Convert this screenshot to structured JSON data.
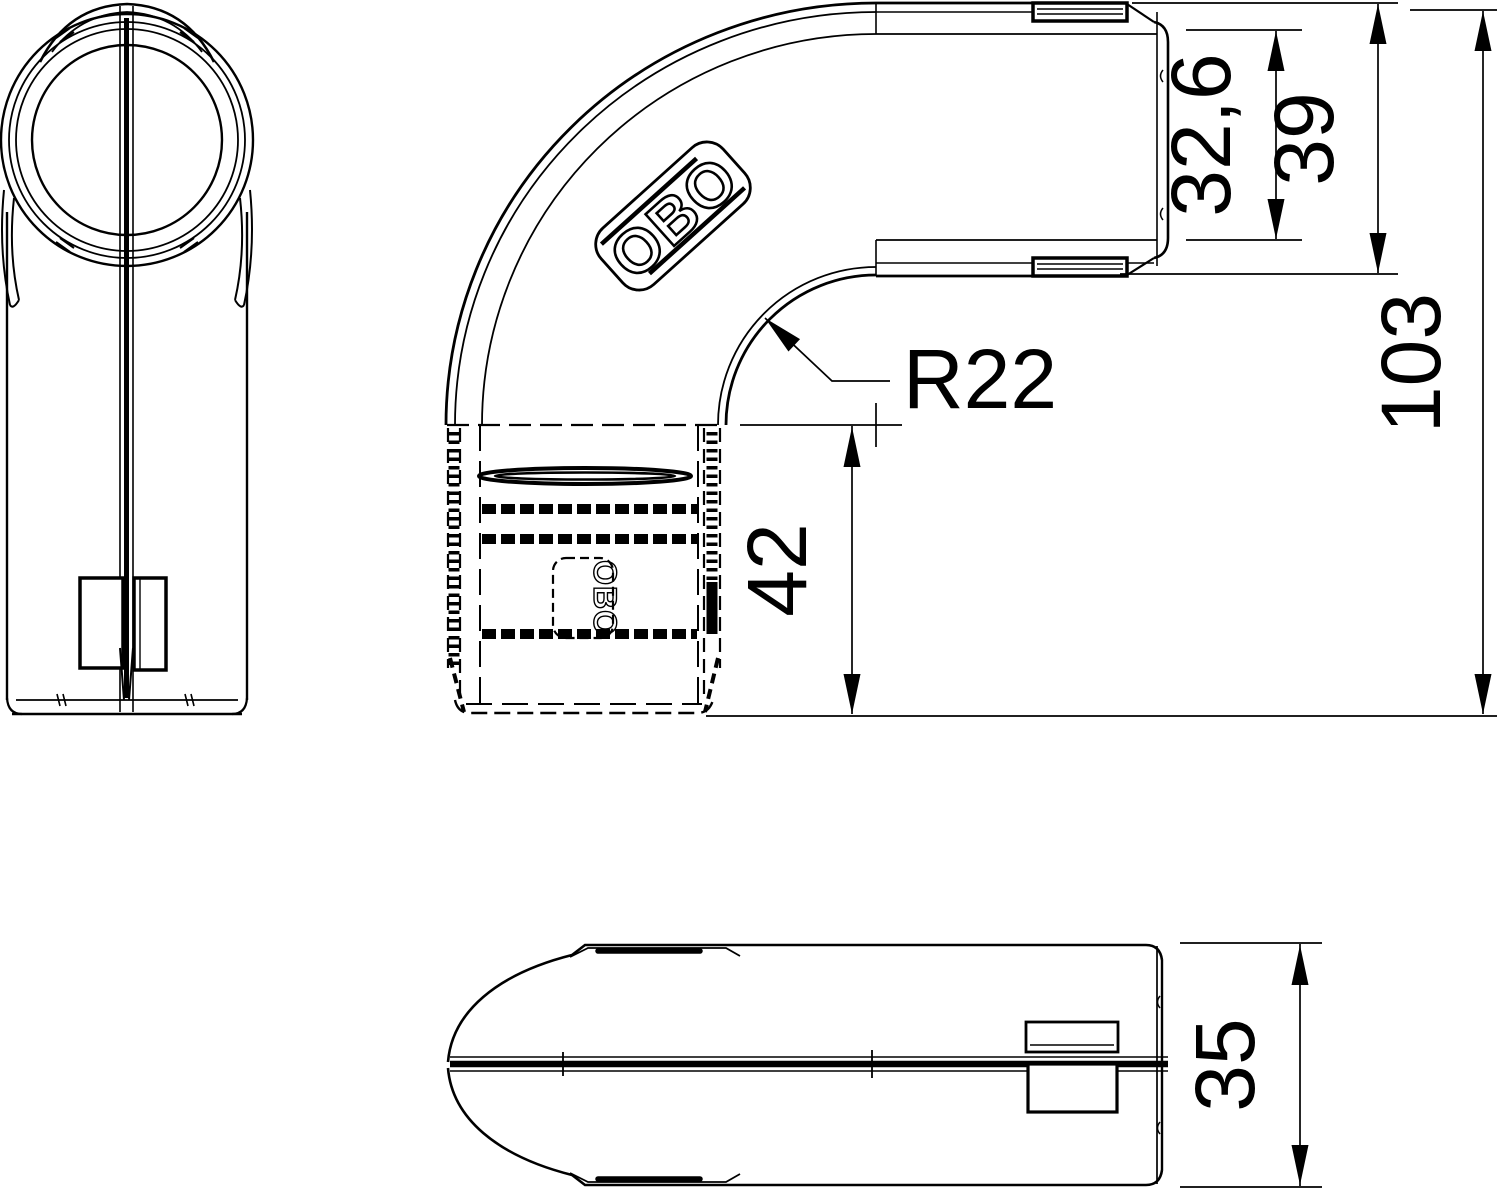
{
  "colors": {
    "line": "#000000",
    "background": "#ffffff"
  },
  "brand": {
    "logo": "OBO",
    "logo_small": "OBO"
  },
  "dimensions": {
    "inner_opening": "32,6",
    "connector_height": "39",
    "overall_length": "103",
    "bend_radius": "R22",
    "insertion_depth": "42",
    "profile_width": "35"
  }
}
